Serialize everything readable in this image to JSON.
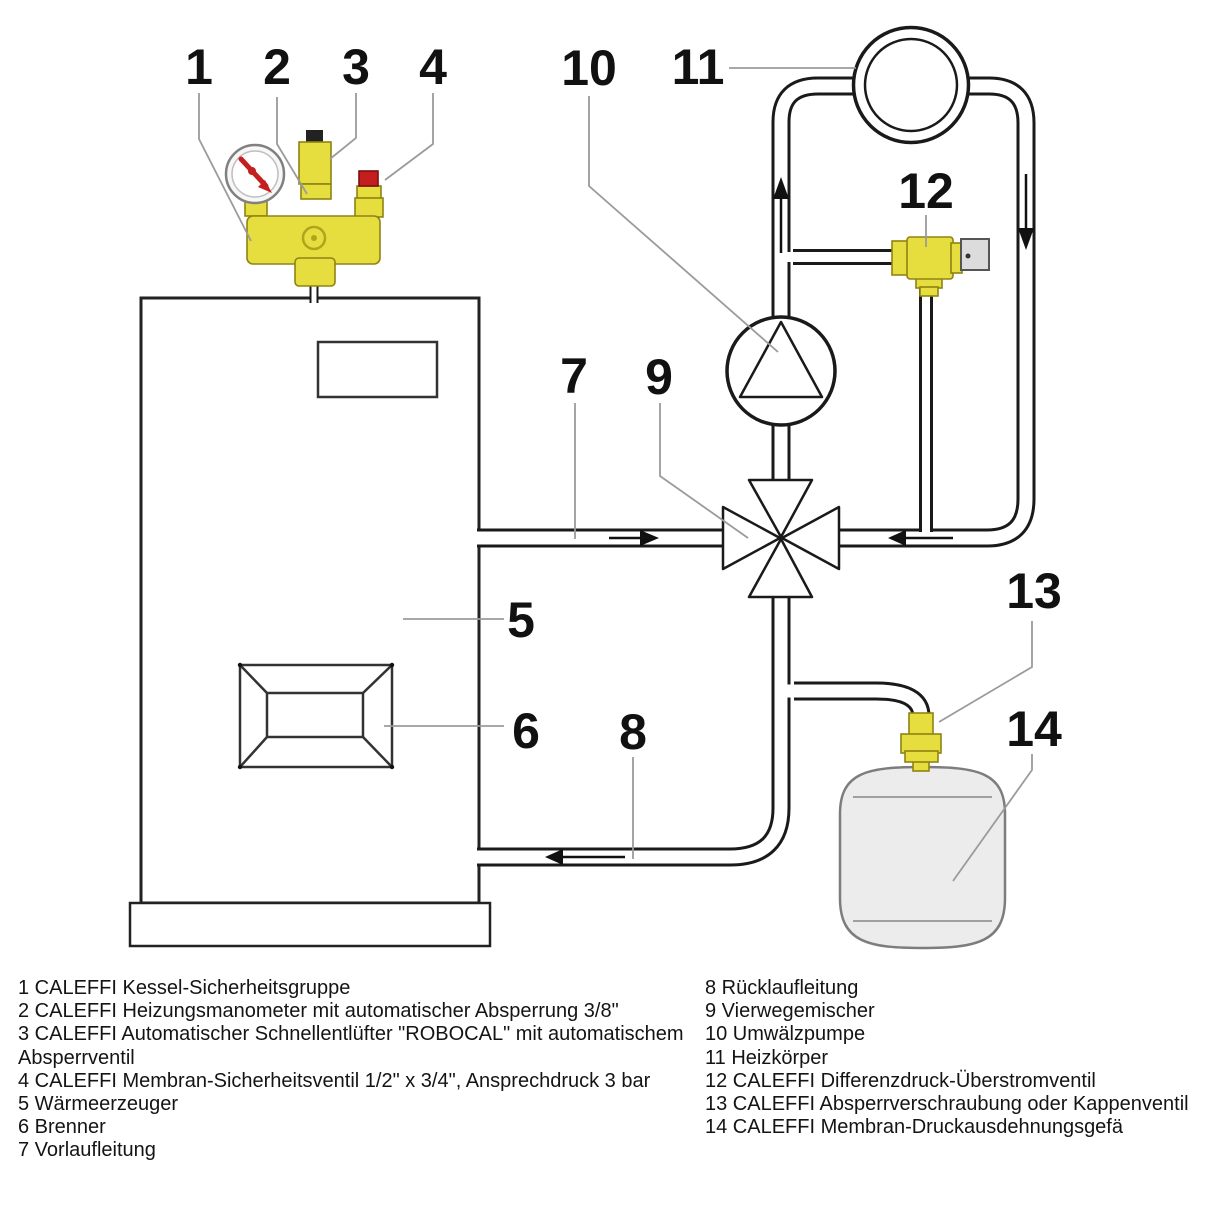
{
  "diagram": {
    "callouts": [
      "1",
      "2",
      "3",
      "4",
      "5",
      "6",
      "7",
      "8",
      "9",
      "10",
      "11",
      "12",
      "13",
      "14"
    ]
  },
  "legend": {
    "left": [
      "1 CALEFFI Kessel-Sicherheitsgruppe",
      "2 CALEFFI Heizungsmanometer mit automatischer Absperrung 3/8\"",
      "3 CALEFFI Automatischer Schnellentlüfter \"ROBOCAL\" mit automatischem",
      "Absperrventil",
      "4 CALEFFI Membran-Sicherheitsventil 1/2\" x 3/4\", Ansprechdruck 3 bar",
      "5 Wärmeerzeuger",
      "6 Brenner",
      "7 Vorlaufleitung"
    ],
    "right": [
      "8 Rücklaufleitung",
      "9 Vierwegemischer",
      "10 Umwälzpumpe",
      "11 Heizkörper",
      "12 CALEFFI Differenzdruck-Überstromventil",
      "13 CALEFFI Absperrverschraubung oder Kappenventil",
      "14 CALEFFI Membran-Druckausdehnungsgefä"
    ]
  },
  "colors": {
    "brass_yellow": "#e6dd3f",
    "red": "#c41e1e",
    "valve_cap_gray": "#dcdcdc",
    "vessel_gray": "#ececec",
    "line_black": "#1a1a1a",
    "leader_gray": "#9b9b9b"
  }
}
